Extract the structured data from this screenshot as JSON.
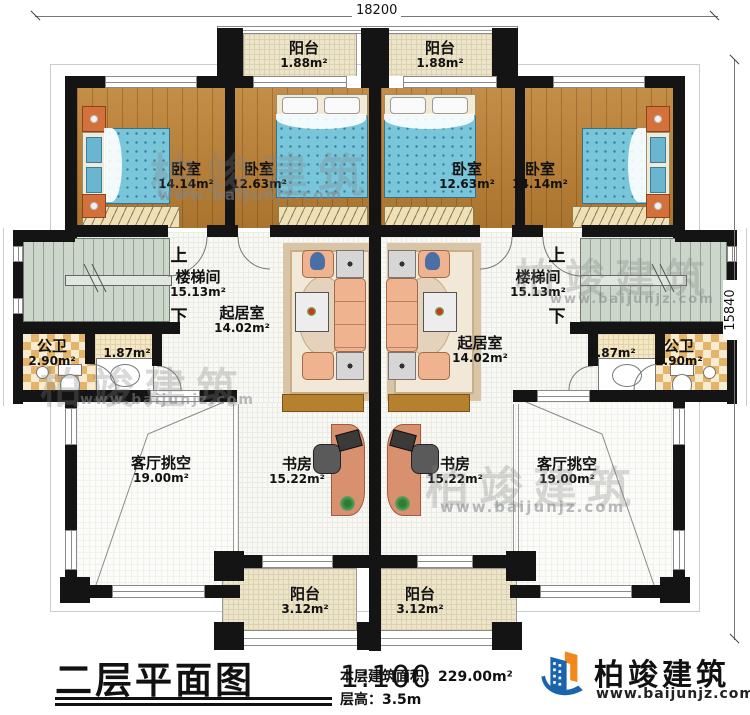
{
  "dimensions": {
    "top": "18200",
    "right": "15840"
  },
  "rooms": {
    "balcony_top_left": {
      "name": "阳台",
      "area": "1.88m²"
    },
    "balcony_top_right": {
      "name": "阳台",
      "area": "1.88m²"
    },
    "bedroom_left_outer": {
      "name": "卧室",
      "area": "14.14m²"
    },
    "bedroom_left_inner": {
      "name": "卧室",
      "area": "12.63m²"
    },
    "bedroom_right_inner": {
      "name": "卧室",
      "area": "12.63m²"
    },
    "bedroom_right_outer": {
      "name": "卧室",
      "area": "14.14m²"
    },
    "stair_left": {
      "name": "楼梯间",
      "area": "15.13m²",
      "up": "上",
      "down": "下"
    },
    "stair_right": {
      "name": "楼梯间",
      "area": "15.13m²",
      "up": "上",
      "down": "下"
    },
    "bath_left": {
      "name": "公卫",
      "area": "2.90m²",
      "vestibule_area": "1.87m²"
    },
    "bath_right": {
      "name": "公卫",
      "area": "2.90m²",
      "vestibule_area": "1.87m²"
    },
    "living_left": {
      "name": "起居室",
      "area": "14.02m²"
    },
    "living_right": {
      "name": "起居室",
      "area": "14.02m²"
    },
    "void_left": {
      "name": "客厅挑空",
      "area": "19.00m²"
    },
    "void_right": {
      "name": "客厅挑空",
      "area": "19.00m²"
    },
    "study_left": {
      "name": "书房",
      "area": "15.22m²"
    },
    "study_right": {
      "name": "书房",
      "area": "15.22m²"
    },
    "balcony_bottom_left": {
      "name": "阳台",
      "area": "3.12m²"
    },
    "balcony_bottom_right": {
      "name": "阳台",
      "area": "3.12m²"
    }
  },
  "title_block": {
    "title": "二层平面图",
    "scale": "1:100",
    "area_label": "本层建筑面积：",
    "area_value": "229.00m²",
    "floor_height_label": "层高：",
    "floor_height_value": "3.5m"
  },
  "brand": {
    "name": "柏竣建筑",
    "website": "www.baijunjz.com"
  },
  "watermark": {
    "text": "柏竣建筑",
    "website": "www.baijunjz.com"
  },
  "colors": {
    "wall": "#141414",
    "wood_floor": "#bd8134",
    "bed": "#79c6db",
    "stair_floor": "#ccd6cb",
    "bath_tile": "#e3b469",
    "balcony_floor": "#ede5cb",
    "logo_blue": "#1a64ad",
    "logo_orange": "#f0881c"
  }
}
